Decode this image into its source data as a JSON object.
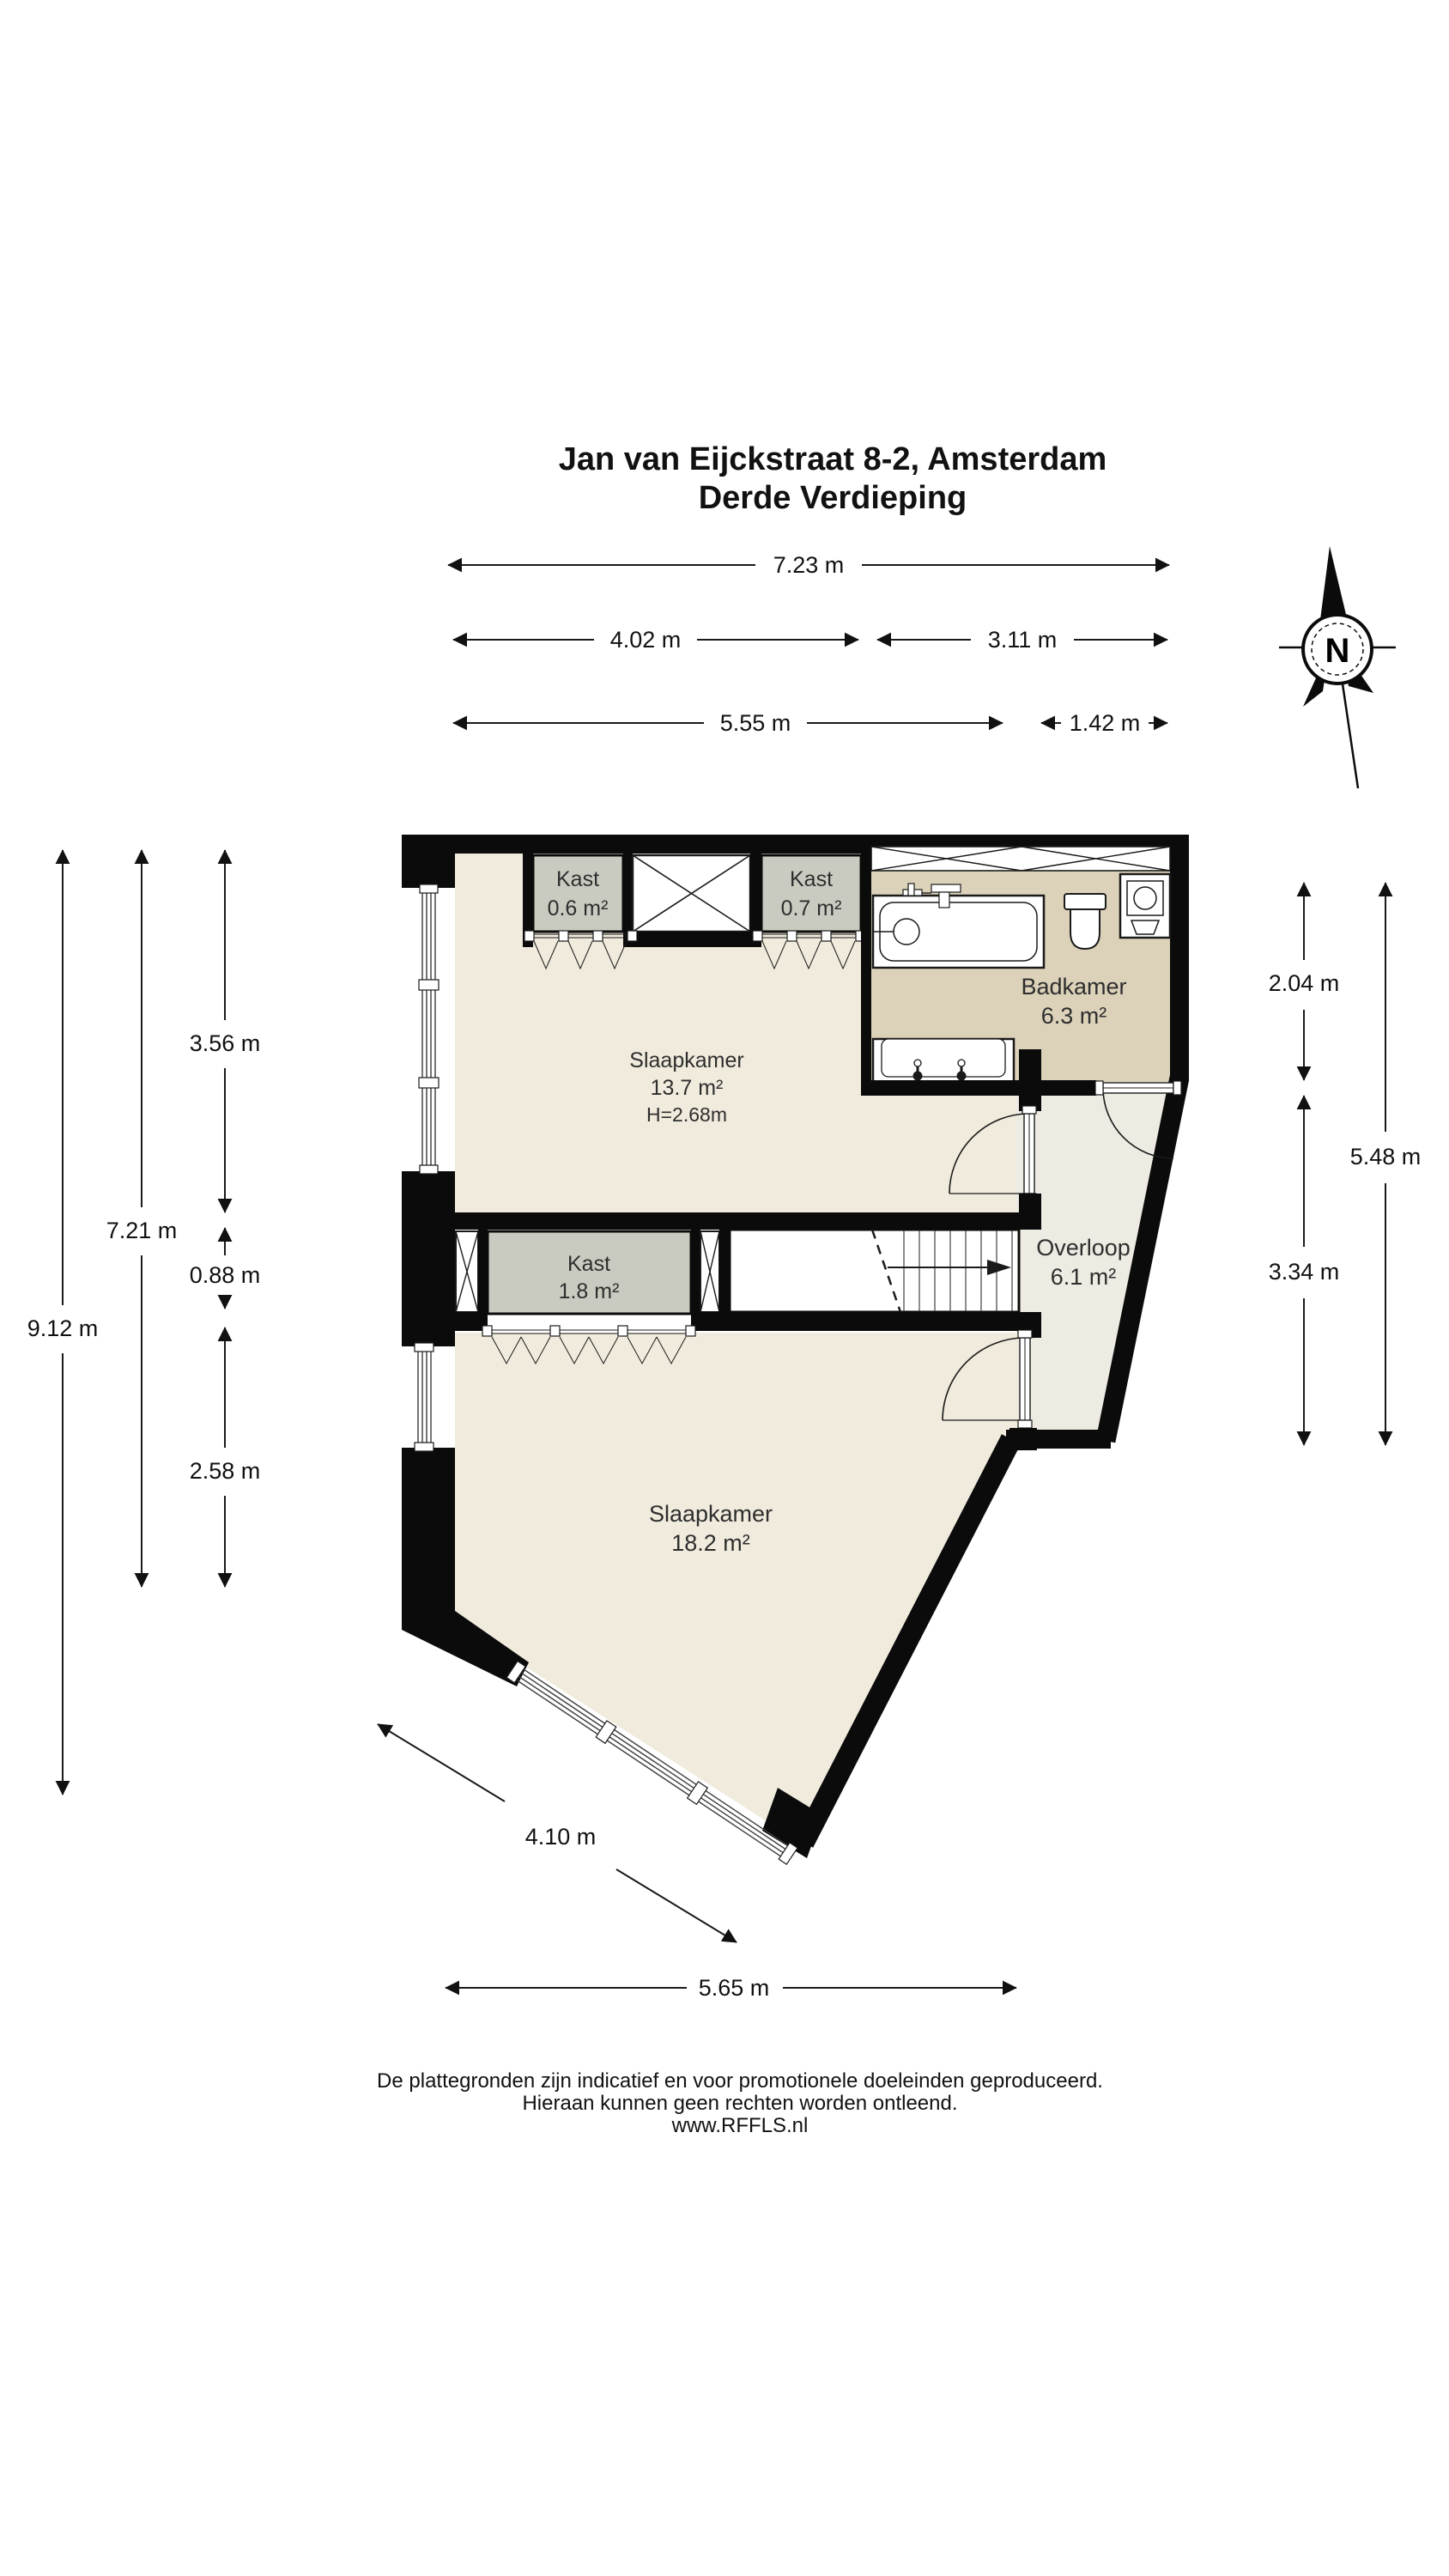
{
  "header": {
    "title_line1": "Jan van Eijckstraat 8-2, Amsterdam",
    "title_line2": "Derde Verdieping"
  },
  "compass": {
    "label": "N"
  },
  "dimensions": {
    "top_total": "7.23 m",
    "top_left": "4.02 m",
    "top_right": "3.11 m",
    "top_lower_left": "5.55 m",
    "top_lower_right": "1.42 m",
    "left_total": "9.12 m",
    "left_inner": "7.21 m",
    "left_a": "3.56 m",
    "left_b": "0.88 m",
    "left_c": "2.58 m",
    "right_a": "2.04 m",
    "right_total": "5.48 m",
    "right_b": "3.34 m",
    "bottom_diag": "4.10 m",
    "bottom_total": "5.65 m"
  },
  "rooms": {
    "kast_a": {
      "name": "Kast",
      "area": "0.6 m²"
    },
    "kast_b": {
      "name": "Kast",
      "area": "0.7 m²"
    },
    "badkamer": {
      "name": "Badkamer",
      "area": "6.3 m²"
    },
    "slaapkamer_voor": {
      "name": "Slaapkamer",
      "area": "13.7 m²",
      "ceiling": "H=2.68m"
    },
    "kast_c": {
      "name": "Kast",
      "area": "1.8 m²"
    },
    "overloop": {
      "name": "Overloop",
      "area": "6.1 m²"
    },
    "slaapkamer_achter": {
      "name": "Slaapkamer",
      "area": "18.2 m²"
    }
  },
  "footer": {
    "line1": "De plattegronden zijn indicatief en voor promotionele doeleinden geproduceerd.",
    "line2": "Hieraan kunnen geen rechten worden ontleend.",
    "line3": "www.RFFLS.nl"
  },
  "colors": {
    "wall": "#0b0b0b",
    "floor": "#f0ebdc",
    "bathroom-floor": "#dcd2ba",
    "closet-fill": "#c9cbc1",
    "landing-floor": "#edebe2",
    "dim-line": "#1a1a1a",
    "label-text": "#2e2e2e"
  }
}
